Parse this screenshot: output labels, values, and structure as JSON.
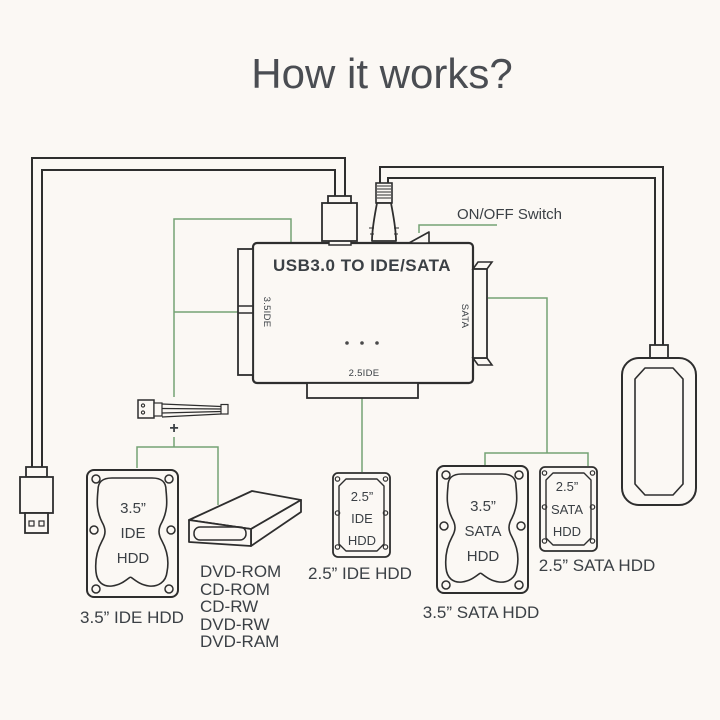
{
  "title": "How it works?",
  "colors": {
    "background": "#fbf8f4",
    "line": "#2e2e2e",
    "green": "#74a274",
    "text": "#3b4045",
    "title": "#4a4d52"
  },
  "adapter": {
    "label": "USB3.0 TO IDE/SATA",
    "left_port": "3.5IDE",
    "right_port": "SATA",
    "bottom_port": "2.5IDE",
    "switch_label": "ON/OFF Switch",
    "plus": "+"
  },
  "devices": {
    "hdd_ide_35": {
      "size": "3.5”",
      "bus": "IDE",
      "type": "HDD",
      "caption": "3.5”  IDE HDD"
    },
    "optical_drive": {
      "items": [
        "DVD-ROM",
        "CD-ROM",
        "CD-RW",
        "DVD-RW",
        "DVD-RAM"
      ]
    },
    "hdd_ide_25": {
      "size": "2.5”",
      "bus": "IDE",
      "type": "HDD",
      "caption": "2.5”  IDE HDD"
    },
    "hdd_sata_35": {
      "size": "3.5”",
      "bus": "SATA",
      "type": "HDD",
      "caption": "3.5”  SATA HDD"
    },
    "hdd_sata_25": {
      "size": "2.5”",
      "bus": "SATA",
      "type": "HDD",
      "caption": "2.5”  SATA HDD"
    }
  }
}
